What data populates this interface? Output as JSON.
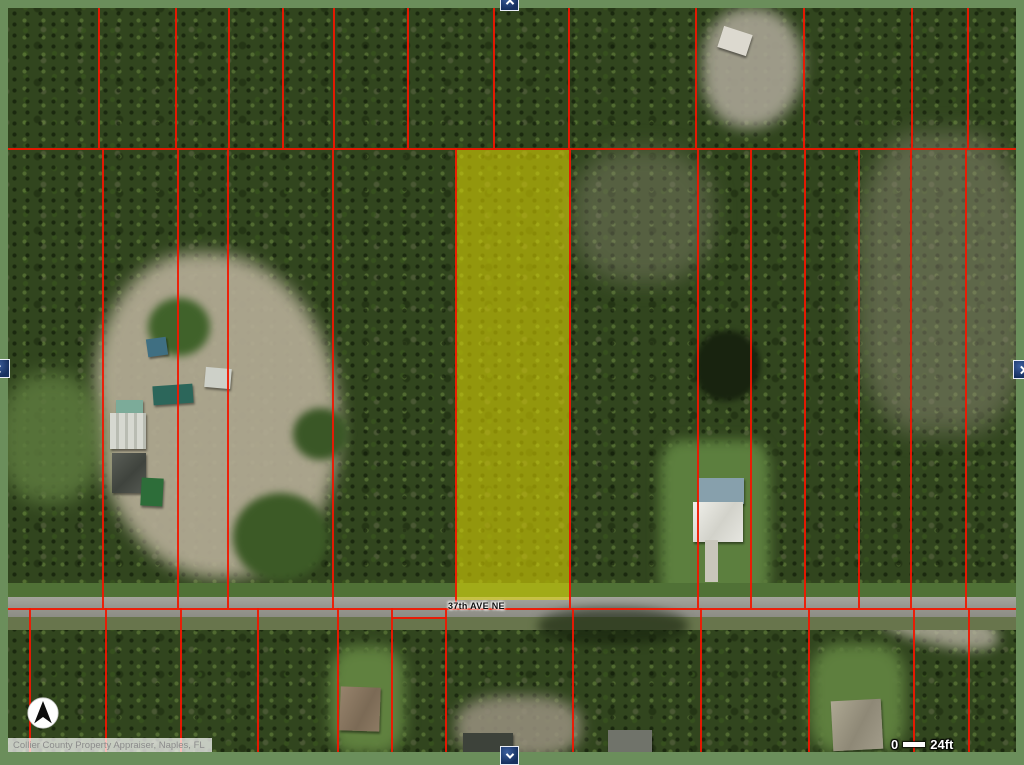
{
  "window": {
    "frame_color": "#6b8e5b",
    "app": "Collier County Property Appraiser map viewer"
  },
  "map": {
    "street_label": "37th AVE NE",
    "attribution": "Collier County Property Appraiser, Naples, FL",
    "scale_bar": {
      "start_label": "0",
      "end_label": "24ft"
    },
    "compass_icon": "north-arrow",
    "road_color": "#9a9a92",
    "highlight": {
      "color": "#e3da00",
      "opacity": 0.55,
      "x": 447,
      "y": 142,
      "width": 114,
      "height": 450
    },
    "parcel_lines": {
      "color": "#f21600",
      "hlines": [
        {
          "y": 140,
          "x1": 0,
          "x2": 1008
        },
        {
          "y": 600,
          "x1": 0,
          "x2": 1008
        }
      ],
      "segments": [
        {
          "y": 609,
          "x1": 384,
          "x2": 439
        }
      ],
      "bands": [
        {
          "name": "north",
          "y1": 0,
          "y2": 140,
          "xs": [
            90,
            167,
            220,
            274,
            325,
            399,
            485,
            560,
            687,
            795,
            903,
            959
          ]
        },
        {
          "name": "main",
          "y1": 140,
          "y2": 600,
          "xs": [
            94,
            169,
            219,
            324,
            447,
            561,
            689,
            742,
            796,
            850,
            902,
            957
          ]
        },
        {
          "name": "south",
          "y1": 600,
          "y2": 744,
          "xs": [
            21,
            97,
            172,
            249,
            329,
            383,
            437,
            564,
            692,
            800,
            905,
            960
          ]
        }
      ]
    }
  },
  "nav": {
    "up_icon": "chevron-up",
    "down_icon": "chevron-down",
    "left_icon": "chevron-left",
    "right_icon": "chevron-right"
  }
}
